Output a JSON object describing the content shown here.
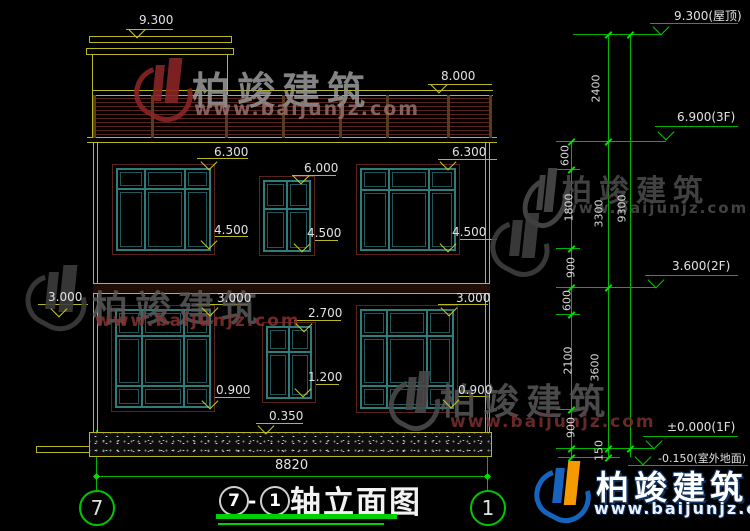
{
  "brand": {
    "name": "柏竣建筑",
    "url": "www.baijunjz.com"
  },
  "title": {
    "circle_a": "7",
    "dash": "-",
    "circle_b": "1",
    "text": "轴立面图"
  },
  "axes": {
    "left": "7",
    "right": "1"
  },
  "bottom_width": "8820",
  "marks": {
    "bulkhead_top": "9.300",
    "railing_top": "8.000",
    "w1_top": "6.300",
    "w2_top": "6.000",
    "w3_top": "6.300",
    "w1_sill": "4.500",
    "w2_sill": "4.500",
    "w3_sill": "4.500",
    "band_left": "3.000",
    "w4_top": "3.000",
    "w6_top": "3.000",
    "w5_top": "2.700",
    "w5_sill": "1.200",
    "w4_sill": "0.900",
    "w6_sill": "0.900",
    "plinth_top": "0.350"
  },
  "levels": {
    "roof": "9.300(屋顶)",
    "f3": "6.900(3F)",
    "f2": "3.600(2F)",
    "f1": "±0.000(1F)",
    "ground": "-0.150(室外地面)"
  },
  "chains": {
    "c2400": "2400",
    "c600a": "600",
    "c1800": "1800",
    "c900a": "900",
    "c600b": "600",
    "c2100": "2100",
    "c900b": "900",
    "c150": "150",
    "c3300": "3300",
    "c3600": "3600",
    "c9300": "9300"
  }
}
